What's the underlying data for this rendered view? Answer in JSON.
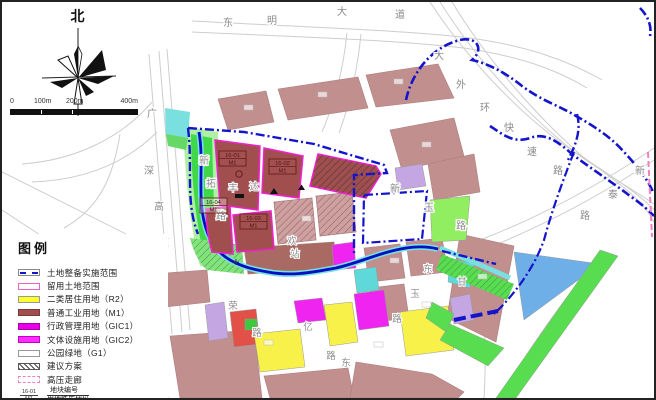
{
  "compass": {
    "label": "北"
  },
  "scale_bar": {
    "ticks": [
      "0",
      "100m",
      "200m",
      "400m"
    ]
  },
  "legend": {
    "title": "图例",
    "items": [
      {
        "label": "土地整备实施范围",
        "swatch": "blue-dashdot-line"
      },
      {
        "label": "留用土地范围",
        "swatch": "pink-outline"
      },
      {
        "label": "二类居住用地（R2）",
        "swatch": "yellow-fill"
      },
      {
        "label": "普通工业用地（M1）",
        "swatch": "dark-red-fill"
      },
      {
        "label": "行政管理用地（GIC1）",
        "swatch": "magenta-fill"
      },
      {
        "label": "文体设施用地（GIC2）",
        "swatch": "magenta-fill"
      },
      {
        "label": "公园绿地（G1）",
        "swatch": "white-outline"
      },
      {
        "label": "建议方案",
        "swatch": "diagonal-hatch"
      },
      {
        "label": "高压走廊",
        "swatch": "pink-dashed-outline"
      }
    ],
    "code_item": {
      "top": "地块编号",
      "bottom": "用地性质代码",
      "sample_id": "16-01",
      "sample_code": "M1"
    }
  },
  "parcels": [
    {
      "id": "16-01",
      "code": "M1"
    },
    {
      "id": "16-02",
      "code": "M1"
    },
    {
      "id": "16-03",
      "code": "M1"
    },
    {
      "id": "16-04",
      "code": "M1"
    }
  ],
  "roads": [
    {
      "name": "东明大道",
      "chars": [
        "东",
        "明",
        "大",
        "道"
      ]
    },
    {
      "name": "大外环快速路",
      "chars": [
        "大",
        "外",
        "环",
        "快",
        "速",
        "路"
      ]
    },
    {
      "name": "新泰路",
      "chars": [
        "新",
        "泰",
        "路"
      ]
    },
    {
      "name": "广深高速",
      "chars": [
        "广",
        "深",
        "高",
        "速"
      ]
    },
    {
      "name": "新拓路",
      "chars": [
        "新",
        "拓",
        "路"
      ]
    },
    {
      "name": "新玉路",
      "chars": [
        "新",
        "玉",
        "路"
      ]
    }
  ],
  "map_labels": [
    {
      "text": "荣"
    },
    {
      "text": "路"
    },
    {
      "text": "亿"
    },
    {
      "text": "路"
    },
    {
      "text": "东"
    },
    {
      "text": "东"
    },
    {
      "text": "甘"
    },
    {
      "text": "玉"
    },
    {
      "text": "路"
    },
    {
      "text": "丰"
    },
    {
      "text": "达"
    },
    {
      "text": "欢"
    },
    {
      "text": "站"
    }
  ],
  "colors": {
    "boundary_blue": "#1414CC",
    "river_blue": "#0010C0",
    "river_cyan": "#7ADFDF",
    "industrial_m1": "#A04E4E",
    "residential_r2_yellow": "#FFFF29",
    "gic_magenta": "#EE00EE",
    "retained_outline_pink": "#F060C0",
    "existing_parcel_rose": "#C28F8F",
    "park_green": "#3FD849",
    "light_green": "#AFF0A4",
    "water_parcel_blue": "#6FAFE8",
    "purple_parcel": "#C4A6E2",
    "red_parcel": "#E25048"
  }
}
